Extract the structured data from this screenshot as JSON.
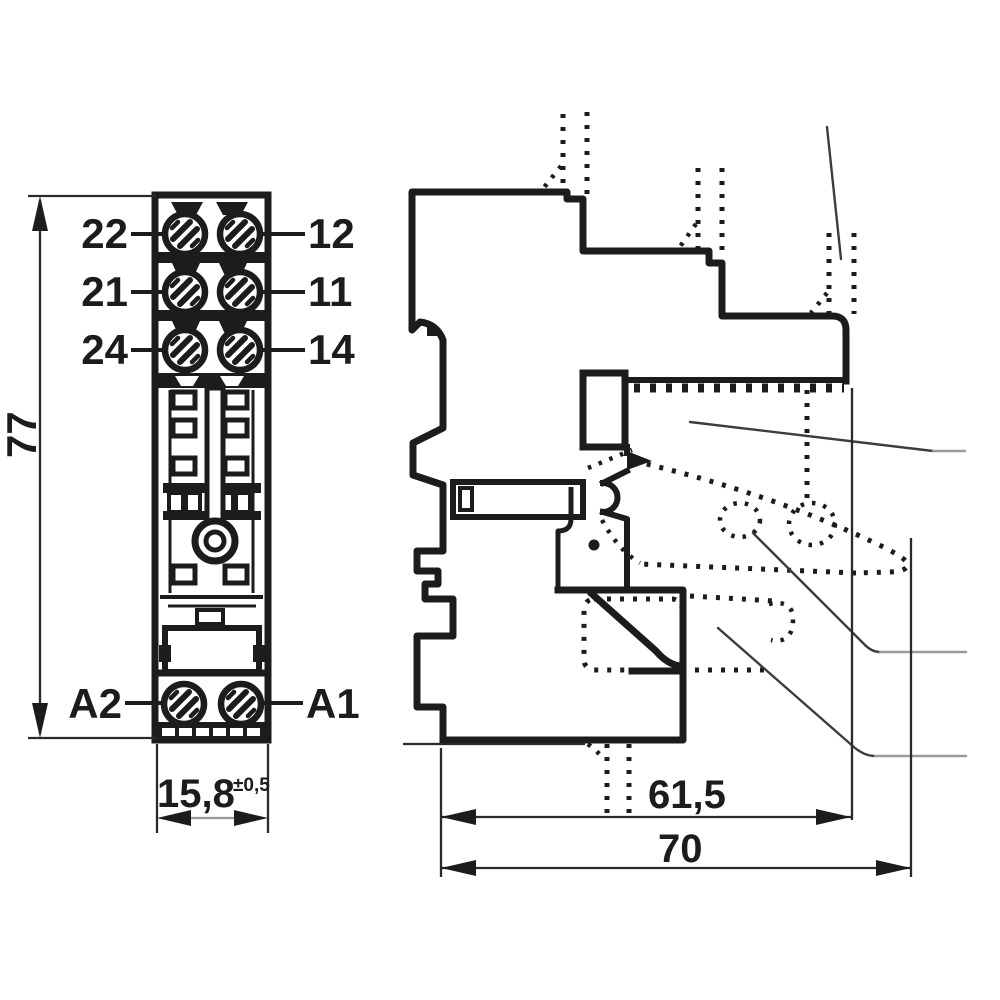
{
  "front_view": {
    "terminal_labels_left": [
      "22",
      "21",
      "24"
    ],
    "terminal_labels_right": [
      "12",
      "11",
      "14"
    ],
    "coil_label_left": "A2",
    "coil_label_right": "A1",
    "height_dimension": "77",
    "width_dimension": "15,8",
    "width_tolerance": "±0,5"
  },
  "side_view": {
    "depth_dimension_socket": "61,5",
    "depth_dimension_overall": "70"
  },
  "colors": {
    "line": "#1c1c1c",
    "leader": "#3c3c3c",
    "leader_tail": "#9a9a9a",
    "background": "#ffffff"
  }
}
